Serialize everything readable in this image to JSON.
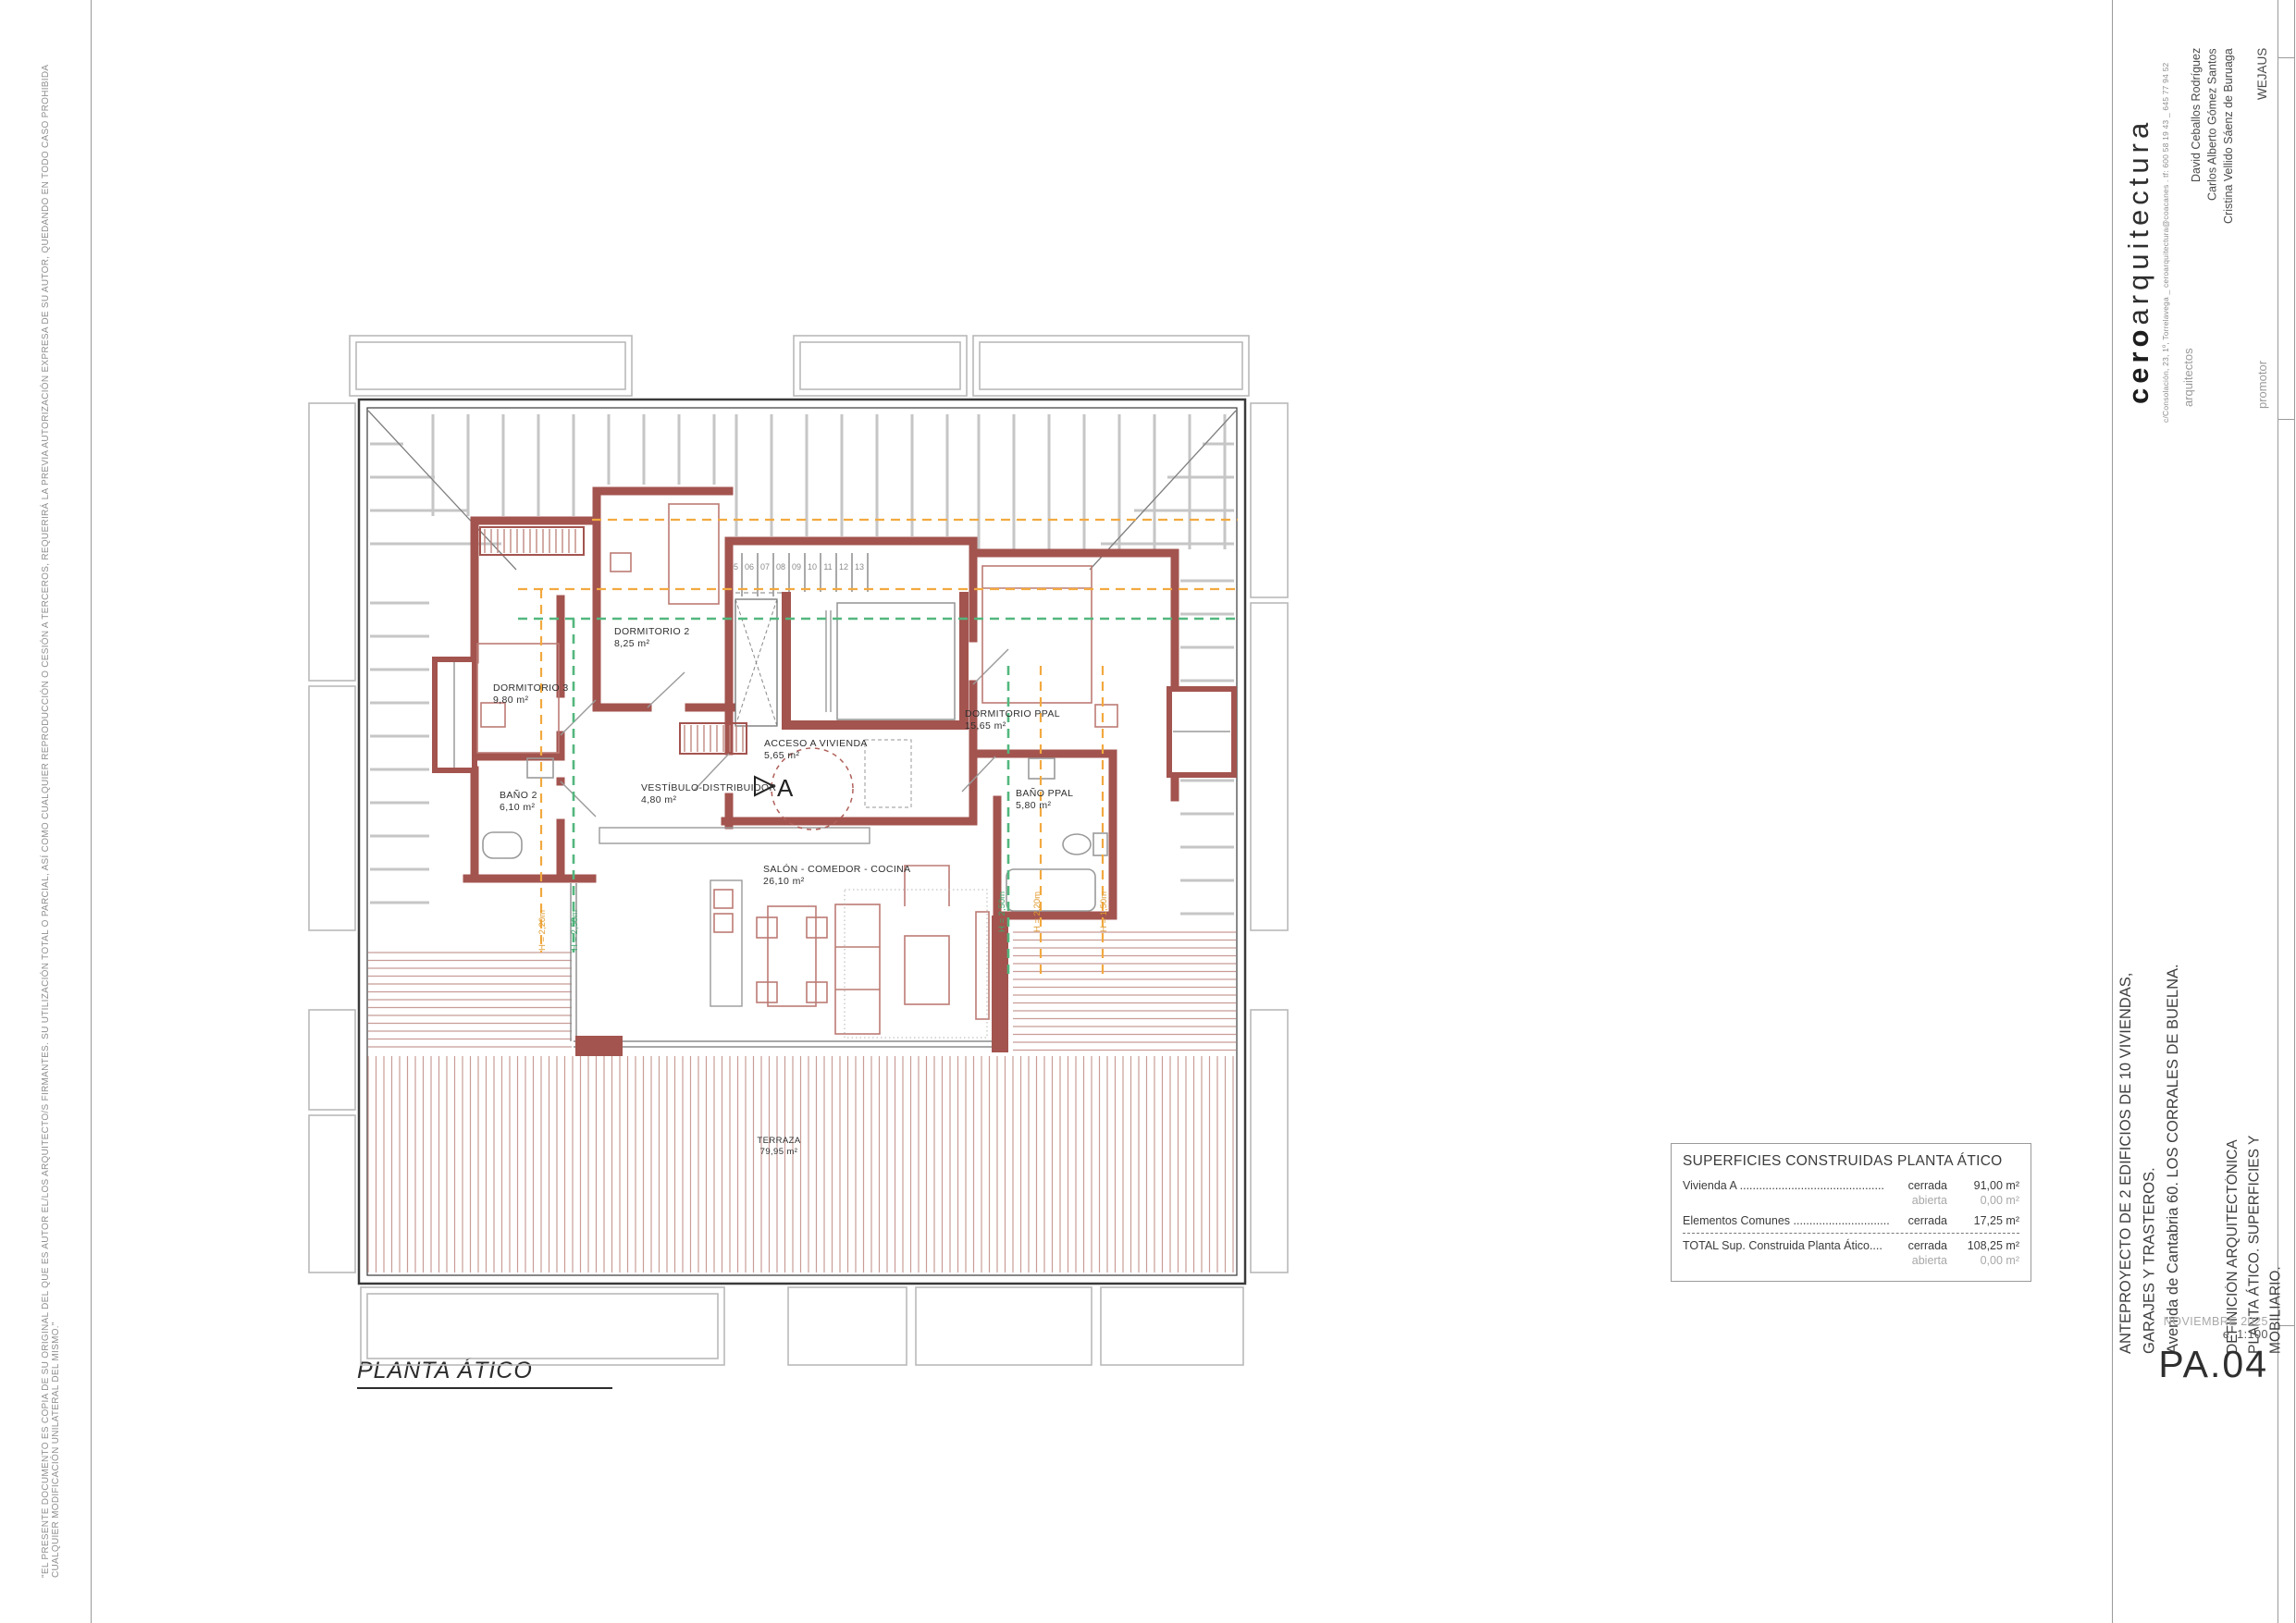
{
  "sheet": {
    "disclaimer": "\"EL PRESENTE DOCUMENTO ES COPIA DE SU ORIGINAL DEL QUE ES AUTOR EL/LOS ARQUITECTO/S FIRMANTES. SU UTILIZACIÓN TOTAL O PARCIAL, ASÍ COMO CUALQUIER REPRODUCCIÓN O CESIÓN A TERCEROS, REQUERIRÁ LA PREVIA AUTORIZACIÓN EXPRESA DE SU AUTOR, QUEDANDO EN TODO CASO PROHIBIDA CUALQUIER MODIFICACIÓN UNILATERAL DEL MISMO.\"",
    "plan_title": "PLANTA ÁTICO"
  },
  "title_block": {
    "studio_bold": "cero",
    "studio_light": "arquitectura",
    "studio_contact": "c/Consolación, 23, 1º, Torrelavega _ ceroarquitectura@coacanes . tf: 600 58 19 43 _ 645 77 94 52",
    "architects_label": "arquitectos",
    "architect_1": "David Ceballos Rodríguez",
    "architect_2": "Carlos Alberto Gómez Santos",
    "architect_3": "Cristina Vellido Sáenz de Buruaga",
    "promoter_label": "promotor",
    "promoter": "WEJAUS",
    "project_line1": "ANTEPROYECTO DE 2 EDIFICIOS DE 10 VIVIENDAS, GARAJES Y TRASTEROS.",
    "project_line2": "Avenida de Cantabria 60. LOS CORRALES DE BUELNA.",
    "drawing_line1": "DEFINICIÓN ARQUITECTÓNICA",
    "drawing_line2": "PLANTA ÁTICO. SUPERFICIES Y MOBILIARIO.",
    "date": "NOVIEMBRE 2025",
    "scale": "e. 1:100",
    "sheet_number": "PA.04"
  },
  "areas_table": {
    "title": "SUPERFICIES CONSTRUIDAS PLANTA ÁTICO",
    "rows": [
      {
        "label": "Vivienda A .............................................",
        "mode": "cerrada",
        "value": "91,00 m²"
      },
      {
        "label": "",
        "mode": "abierta",
        "value": "0,00 m²"
      },
      {
        "label": "Elementos Comunes ..............................",
        "mode": "cerrada",
        "value": "17,25 m²"
      },
      {
        "label": "TOTAL Sup. Construida Planta Ático....",
        "mode": "cerrada",
        "value": "108,25 m²"
      },
      {
        "label": "",
        "mode": "abierta",
        "value": "0,00 m²"
      }
    ]
  },
  "plan": {
    "rooms": {
      "dormitorio2": {
        "name": "DORMITORIO 2",
        "area": "8,25 m²"
      },
      "dormitorio3": {
        "name": "DORMITORIO 3",
        "area": "9,80 m²"
      },
      "bano2": {
        "name": "BAÑO 2",
        "area": "6,10 m²"
      },
      "dormitorioppal": {
        "name": "DORMITORIO PPAL",
        "area": "15,65 m²"
      },
      "acceso": {
        "name": "ACCESO A VIVIENDA",
        "area": "5,65 m²"
      },
      "vestibulo": {
        "name": "VESTÍBULO-DISTRIBUIDOR",
        "area": "4,80 m²"
      },
      "banoppal": {
        "name": "BAÑO PPAL",
        "area": "5,80 m²"
      },
      "salon": {
        "name": "SALÓN - COMEDOR - COCINA",
        "area": "26,10 m²"
      },
      "terraza": {
        "name": "TERRAZA",
        "area": "79,95 m²"
      }
    },
    "stairs": {
      "top": [
        "05",
        "06",
        "07",
        "08",
        "09",
        "10",
        "11",
        "12",
        "13"
      ],
      "side": [
        "14",
        "15",
        "16",
        "17"
      ]
    },
    "heights": {
      "h250": "H = 2,50m",
      "h220": "H = 2,20m",
      "h150": "H = 1,50m"
    },
    "section_marker": "A",
    "colors": {
      "wall": "#a3544f",
      "furniture": "#bc7b74",
      "terrace_hatch": "#c89c97",
      "roof_hatch": "#c6c6c6",
      "green": "#53b77e",
      "orange": "#f2a93f"
    }
  }
}
